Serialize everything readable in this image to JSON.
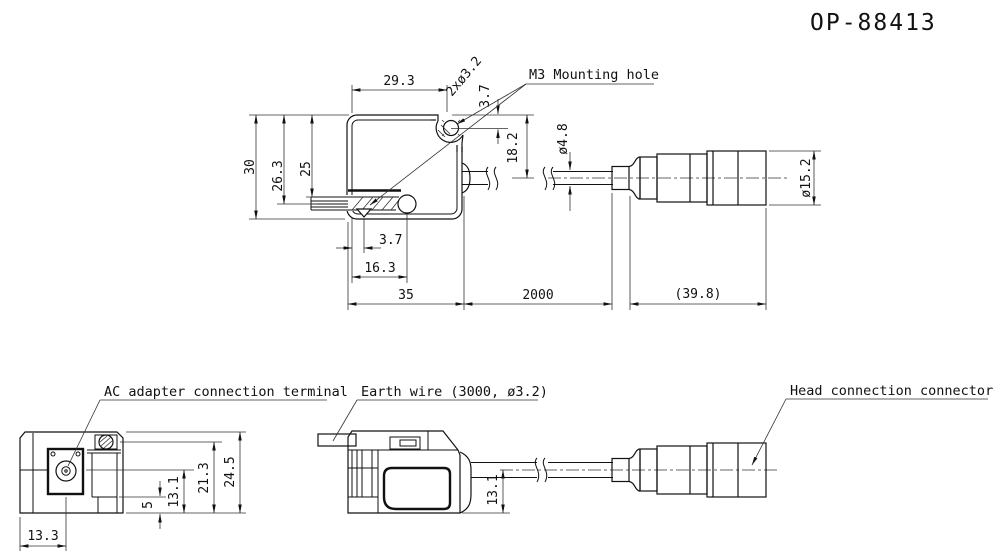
{
  "title": "OP-88413",
  "top_view": {
    "labels": {
      "mounting_hole": "M3 Mounting hole"
    },
    "dims": {
      "body_width_top": "29.3",
      "mounting_holes": "2xø3.2",
      "hole_offset_y": "3.7",
      "body_height": "30",
      "rod_center_from_top": "26.3",
      "rod_top_from_top": "25",
      "cable_center_from_top": "18.2",
      "cable_dia": "ø4.8",
      "connector_dia": "ø15.2",
      "slot_offset": "3.7",
      "screw_center": "16.3",
      "body_width": "35",
      "cable_length": "2000",
      "connector_length": "(39.8)"
    }
  },
  "side_view": {
    "labels": {
      "ac_adapter": "AC adapter connection terminal",
      "earth_wire": "Earth wire (3000, ø3.2)",
      "head_connector": "Head connection connector"
    },
    "dims": {
      "jack_center_x": "13.3",
      "step_height": "5",
      "jack_center_height": "13.1",
      "screw_center_height": "21.3",
      "body_height": "24.5",
      "cable_center_height": "13.1"
    }
  }
}
